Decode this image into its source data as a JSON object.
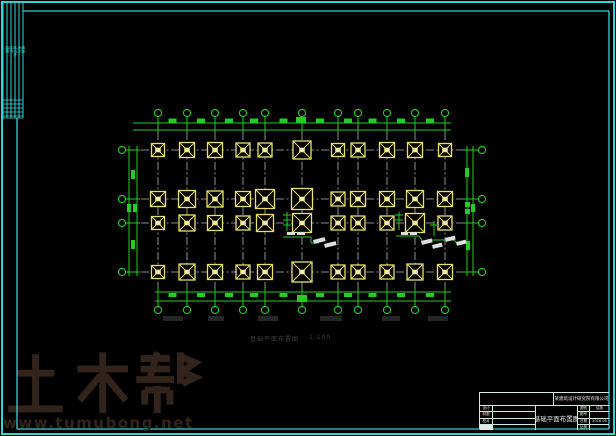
{
  "colors": {
    "frame_cyan": "#35d4d4",
    "dim_green": "#24cc24",
    "cap_yellow": "#e8e06a",
    "cap_center": "#efe9bc",
    "grid_gray": "#b4b4b4",
    "white_mark": "#dedede",
    "watermark_brown": "#33241b",
    "caption_gray": "#3f3f3f",
    "faint_gray": "#262626",
    "background": "#000000"
  },
  "sign_strip": {
    "labels": [
      "建筑",
      "结构",
      "给排水",
      "电气",
      "暖通"
    ]
  },
  "plan": {
    "grid_x": [
      158,
      187,
      215,
      243,
      265,
      302,
      338,
      358,
      387,
      415,
      445
    ],
    "row_y": [
      150,
      199,
      223,
      272
    ],
    "grid_v_top": 117,
    "grid_v_bottom": 306,
    "grid_h_left": 126,
    "grid_h_right": 478,
    "cap_sizes": [
      [
        13,
        15,
        15,
        14,
        14,
        18,
        13,
        14,
        15,
        15,
        13
      ],
      [
        15,
        17,
        16,
        15,
        19,
        21,
        14,
        15,
        15,
        17,
        15
      ],
      [
        13,
        16,
        15,
        14,
        17,
        19,
        14,
        14,
        14,
        19,
        14
      ],
      [
        13,
        16,
        15,
        14,
        15,
        20,
        14,
        14,
        14,
        16,
        15
      ]
    ],
    "top_band": {
      "y1": 123,
      "y2": 130,
      "x1": 133,
      "x2": 451,
      "bubble_y": 113
    },
    "bottom_band": {
      "y1": 292,
      "y2": 301,
      "x1": 155,
      "x2": 451,
      "bubble_y": 310
    },
    "left_band": {
      "x1": 129,
      "x2": 137,
      "y1": 146,
      "y2": 276,
      "bubble_x": 122
    },
    "right_band": {
      "x1": 467,
      "x2": 473,
      "y1": 146,
      "y2": 276,
      "bubble_x": 482
    },
    "bubble_radius": 3.6,
    "big_blobs": [
      {
        "x": 296,
        "y": 117,
        "w": 10,
        "h": 6
      },
      {
        "x": 297,
        "y": 295,
        "w": 10,
        "h": 7
      }
    ],
    "side_blobs": [
      {
        "x": 131,
        "y": 170,
        "w": 4,
        "h": 9
      },
      {
        "x": 127,
        "y": 204,
        "w": 4,
        "h": 8
      },
      {
        "x": 133,
        "y": 204,
        "w": 4,
        "h": 8
      },
      {
        "x": 131,
        "y": 240,
        "w": 4,
        "h": 9
      },
      {
        "x": 465,
        "y": 168,
        "w": 4,
        "h": 9
      },
      {
        "x": 465,
        "y": 202,
        "w": 5,
        "h": 5
      },
      {
        "x": 465,
        "y": 209,
        "w": 5,
        "h": 5
      },
      {
        "x": 471,
        "y": 204,
        "w": 4,
        "h": 8
      },
      {
        "x": 466,
        "y": 241,
        "w": 4,
        "h": 9
      }
    ],
    "leader_lines": [
      [
        287,
        212,
        287,
        231
      ],
      [
        283,
        215,
        291,
        215
      ],
      [
        283,
        220,
        291,
        220
      ],
      [
        283,
        225,
        291,
        225
      ],
      [
        283,
        237,
        311,
        237
      ],
      [
        311,
        237,
        311,
        243
      ],
      [
        311,
        243,
        319,
        243
      ],
      [
        399,
        212,
        399,
        230
      ],
      [
        395,
        215,
        403,
        215
      ],
      [
        395,
        220,
        403,
        220
      ],
      [
        396,
        236,
        419,
        236
      ],
      [
        419,
        236,
        423,
        242
      ],
      [
        434,
        221,
        434,
        236
      ],
      [
        430,
        225,
        438,
        225
      ],
      [
        431,
        240,
        454,
        240
      ],
      [
        454,
        240,
        458,
        245
      ]
    ],
    "white_marks": [
      {
        "x": 287,
        "y": 232,
        "w": 8,
        "h": 3,
        "r": 0
      },
      {
        "x": 297,
        "y": 232,
        "w": 8,
        "h": 3,
        "r": 0
      },
      {
        "x": 313,
        "y": 240,
        "w": 12,
        "h": 4,
        "r": -14
      },
      {
        "x": 324,
        "y": 244,
        "w": 12,
        "h": 4,
        "r": -14
      },
      {
        "x": 401,
        "y": 232,
        "w": 7,
        "h": 3,
        "r": 0
      },
      {
        "x": 410,
        "y": 232,
        "w": 7,
        "h": 3,
        "r": 0
      },
      {
        "x": 421,
        "y": 241,
        "w": 11,
        "h": 4,
        "r": -14
      },
      {
        "x": 432,
        "y": 245,
        "w": 10,
        "h": 4,
        "r": -14
      },
      {
        "x": 445,
        "y": 238,
        "w": 10,
        "h": 4,
        "r": -14
      },
      {
        "x": 456,
        "y": 242,
        "w": 10,
        "h": 4,
        "r": -14
      }
    ],
    "faint_marks": [
      {
        "x": 163,
        "y": 316,
        "w": 20,
        "h": 5
      },
      {
        "x": 208,
        "y": 316,
        "w": 16,
        "h": 5
      },
      {
        "x": 258,
        "y": 316,
        "w": 20,
        "h": 5
      },
      {
        "x": 320,
        "y": 316,
        "w": 22,
        "h": 5
      },
      {
        "x": 382,
        "y": 316,
        "w": 18,
        "h": 5
      },
      {
        "x": 428,
        "y": 316,
        "w": 20,
        "h": 5
      }
    ]
  },
  "caption": {
    "text": "基础平面布置图",
    "scale": "1:100"
  },
  "watermark": {
    "title": "土木帮",
    "url": "www.tumubong.net"
  },
  "title_block": {
    "company": "某建筑设计研究院有限公司",
    "drawing_title": "基础平面布置图",
    "left_rows": [
      {
        "label": "设计"
      },
      {
        "label": "制图"
      },
      {
        "label": "校对"
      },
      {
        "label": "审核"
      }
    ],
    "right_rows": [
      {
        "label": "图别",
        "value": "结施"
      },
      {
        "label": "图号",
        "value": ""
      },
      {
        "label": "日期",
        "value": "2016.06"
      },
      {
        "label": "比例",
        "value": ""
      }
    ]
  }
}
